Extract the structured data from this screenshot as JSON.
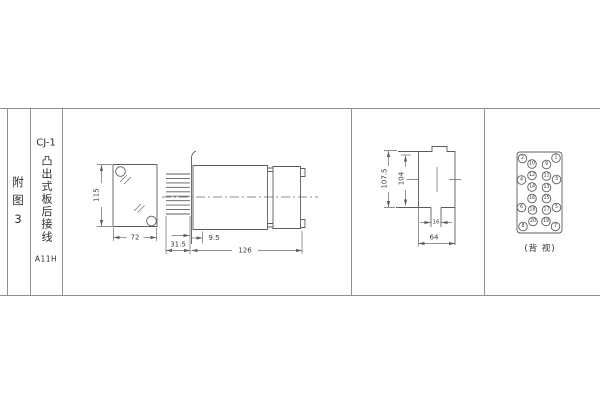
{
  "panel": {
    "figure_label": "附图3",
    "model": "CJ-1",
    "title_vertical": "凸出式板后接线",
    "code": "A11H"
  },
  "front_view": {
    "height": "115",
    "width": "72"
  },
  "side_view": {
    "pin_length": "31.5",
    "panel_offset": "9.5",
    "total_length": "126"
  },
  "profile_view": {
    "outer_height": "107.5",
    "inner_height": "104",
    "tab_width": "16",
    "body_width": "64"
  },
  "back_view": {
    "caption": "(背 视)",
    "terminals": [
      {
        "n": "2",
        "x": 522.5,
        "y": 158.5
      },
      {
        "n": "4",
        "x": 521.5,
        "y": 180
      },
      {
        "n": "6",
        "x": 521.5,
        "y": 207.5
      },
      {
        "n": "8",
        "x": 523,
        "y": 226.5
      },
      {
        "n": "10",
        "x": 532,
        "y": 164
      },
      {
        "n": "12",
        "x": 532,
        "y": 175.5
      },
      {
        "n": "14",
        "x": 532,
        "y": 187
      },
      {
        "n": "16",
        "x": 532,
        "y": 198.5
      },
      {
        "n": "18",
        "x": 532.5,
        "y": 210
      },
      {
        "n": "20",
        "x": 533,
        "y": 221.5
      },
      {
        "n": "9",
        "x": 546.5,
        "y": 164.5
      },
      {
        "n": "11",
        "x": 546.5,
        "y": 176
      },
      {
        "n": "13",
        "x": 546.5,
        "y": 187.5
      },
      {
        "n": "15",
        "x": 546.5,
        "y": 198.5
      },
      {
        "n": "17",
        "x": 546.5,
        "y": 210
      },
      {
        "n": "19",
        "x": 546,
        "y": 221.5
      },
      {
        "n": "1",
        "x": 556,
        "y": 158
      },
      {
        "n": "3",
        "x": 556.5,
        "y": 179.5
      },
      {
        "n": "5",
        "x": 556.5,
        "y": 207.5
      },
      {
        "n": "7",
        "x": 555.5,
        "y": 226.5
      }
    ]
  }
}
